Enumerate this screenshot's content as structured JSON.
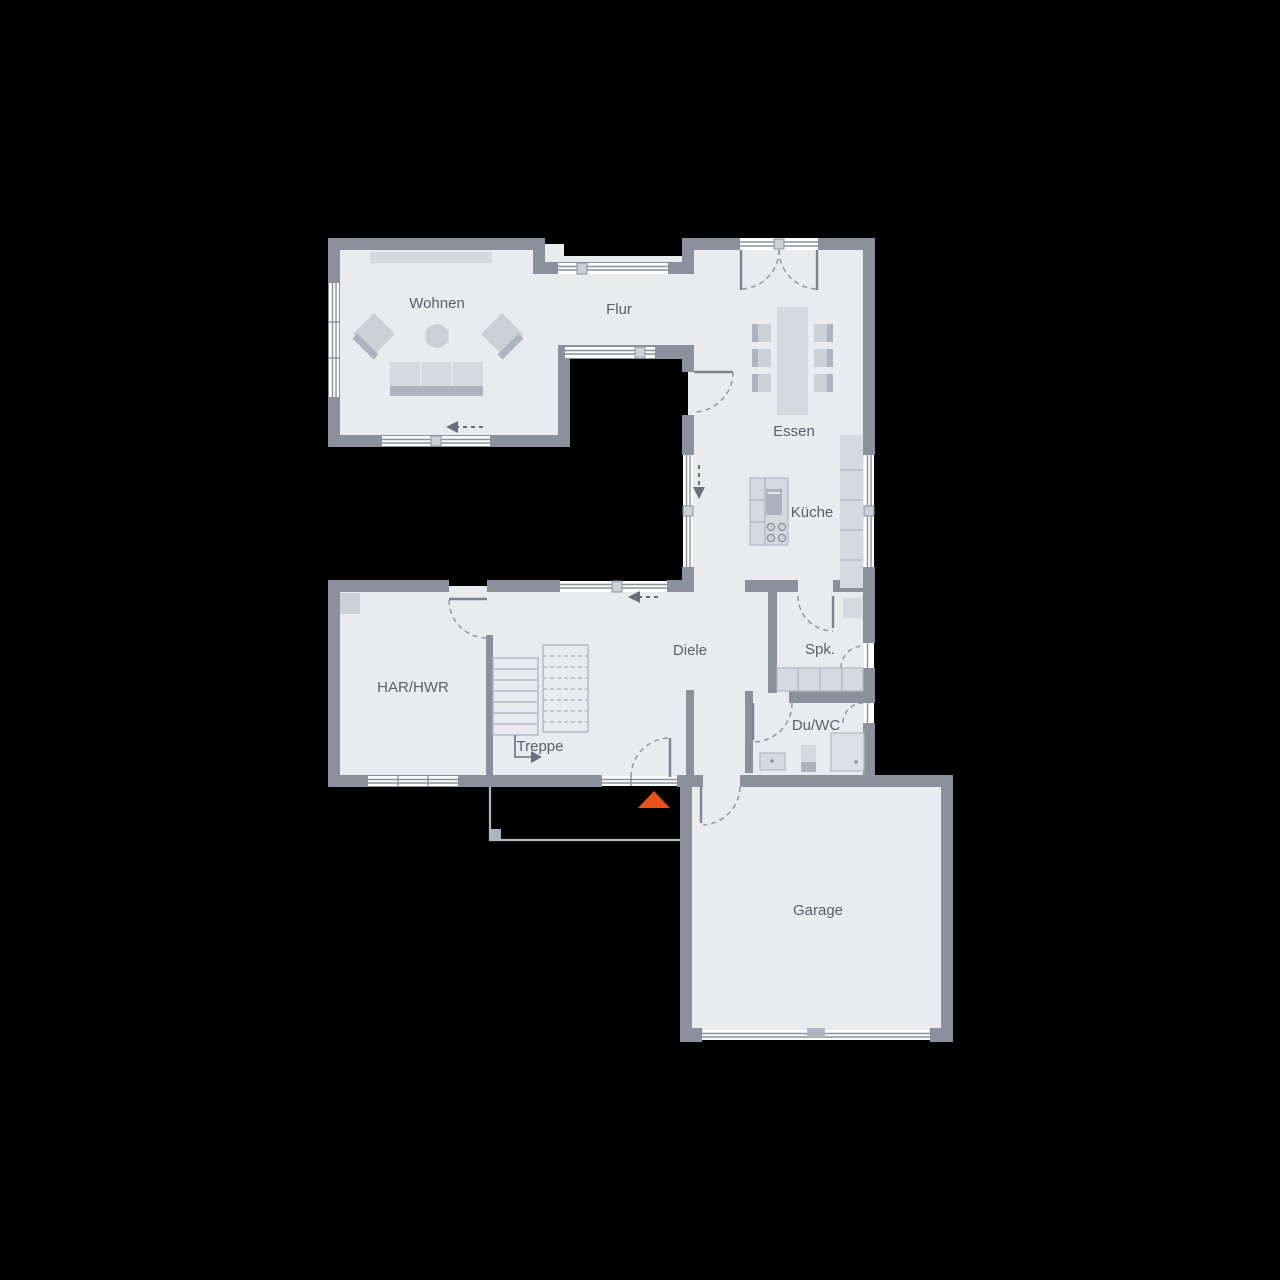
{
  "plan": {
    "type": "floor-plan",
    "rooms": [
      {
        "id": "wohnen",
        "label": "Wohnen"
      },
      {
        "id": "flur",
        "label": "Flur"
      },
      {
        "id": "essen",
        "label": "Essen"
      },
      {
        "id": "kueche",
        "label": "Küche"
      },
      {
        "id": "diele",
        "label": "Diele"
      },
      {
        "id": "har-hwr",
        "label": "HAR/HWR"
      },
      {
        "id": "treppe",
        "label": "Treppe"
      },
      {
        "id": "spk",
        "label": "Spk."
      },
      {
        "id": "du-wc",
        "label": "Du/WC"
      },
      {
        "id": "garage",
        "label": "Garage"
      }
    ],
    "markers": [
      {
        "id": "entrance",
        "shape": "triangle-up",
        "color": "#e8501c"
      }
    ]
  },
  "colors": {
    "background": "#000000",
    "floor": "#e9ebef",
    "wall": "#8a909c",
    "window": "#ffffff",
    "furniture_light": "#d6d9df",
    "furniture_mid": "#ccd0d7",
    "furniture_dark": "#aeb4bf",
    "outline": "#b2b8c2",
    "label_text": "#5a616c",
    "arrow": "#6a707b",
    "accent_orange": "#e8501c"
  }
}
